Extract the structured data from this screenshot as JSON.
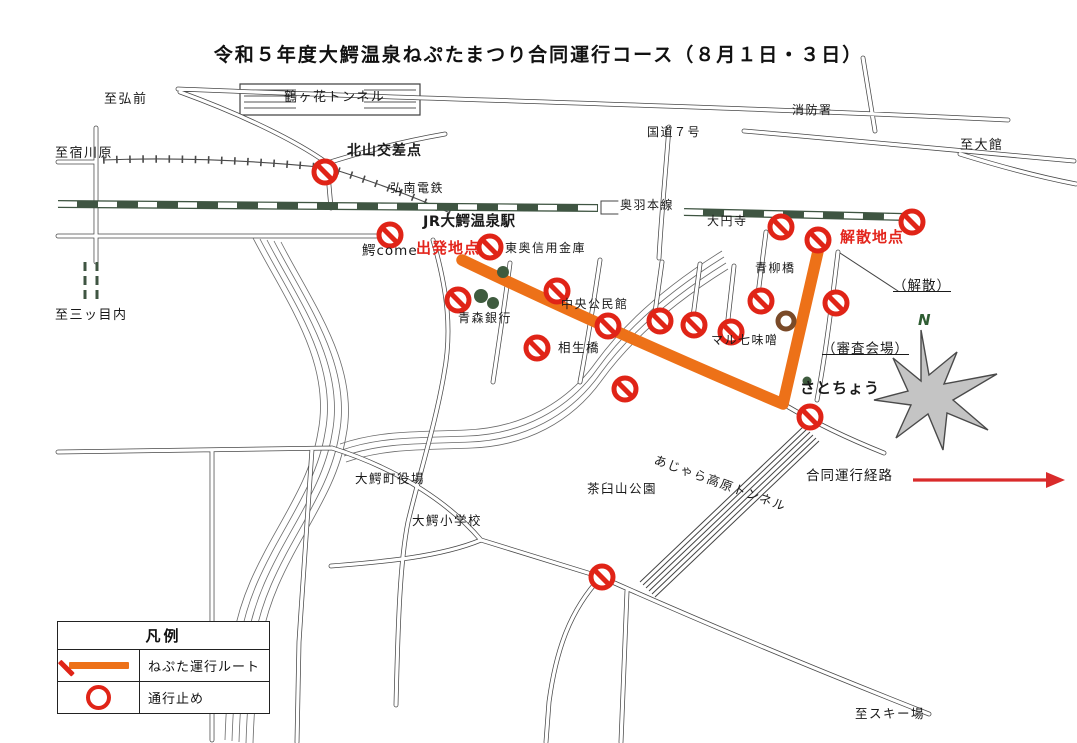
{
  "title": "令和５年度大鰐温泉ねぷたまつり合同運行コース（８月１日・３日）",
  "legend": {
    "title": "凡例",
    "rows": [
      {
        "symbol": "route-line",
        "label": "ねぷた運行ルート"
      },
      {
        "symbol": "no-entry-sign",
        "label": "通行止め"
      }
    ]
  },
  "map": {
    "start_label": "出発地点",
    "end_label": "解散地点",
    "route_direction_label": "合同運行経路",
    "compass_north_label": "N",
    "colors": {
      "route_orange": "#ED7118",
      "closure_red": "#E02417",
      "red_text": "#E3251C",
      "railway_green": "#3F5542",
      "tree_green": "#3E5B3E",
      "landmark_brown": "#7A4A28",
      "arrow_red": "#D92B2B"
    },
    "labels": [
      {
        "id": "to-hirosaki",
        "text": "至弘前",
        "x": 104,
        "y": 93,
        "cls": "s13"
      },
      {
        "id": "tsurugahana-tunnel",
        "text": "鶴ヶ花トンネル",
        "x": 284,
        "y": 91,
        "cls": "s13"
      },
      {
        "id": "to-shukugawara",
        "text": "至宿川原",
        "x": 55,
        "y": 147,
        "cls": "s13"
      },
      {
        "id": "kitayama-intersection",
        "text": "北山交差点",
        "x": 347,
        "y": 144,
        "cls": "b14"
      },
      {
        "id": "konan-railway",
        "text": "弘南電鉄",
        "x": 390,
        "y": 182,
        "cls": ""
      },
      {
        "id": "fire-station",
        "text": "消防署",
        "x": 792,
        "y": 104,
        "cls": ""
      },
      {
        "id": "route-7",
        "text": "国道７号",
        "x": 647,
        "y": 126,
        "cls": ""
      },
      {
        "id": "to-odate",
        "text": "至大館",
        "x": 960,
        "y": 139,
        "cls": "s13"
      },
      {
        "id": "ou-main-line",
        "text": "奥羽本線",
        "x": 620,
        "y": 199,
        "cls": ""
      },
      {
        "id": "daienji",
        "text": "大円寺",
        "x": 707,
        "y": 215,
        "cls": ""
      },
      {
        "id": "dispersal-point",
        "text": "解散地点",
        "x": 840,
        "y": 229,
        "cls": "red"
      },
      {
        "id": "jr-owani-onsen-station",
        "text": "JR大鰐温泉駅",
        "x": 423,
        "y": 215,
        "cls": "b145"
      },
      {
        "id": "departure-point",
        "text": "出発地点",
        "x": 416,
        "y": 240,
        "cls": "red"
      },
      {
        "id": "wani-come",
        "text": "鰐come",
        "x": 362,
        "y": 244,
        "cls": "s135"
      },
      {
        "id": "toou-shinkin-bank",
        "text": "東奥信用金庫",
        "x": 505,
        "y": 242,
        "cls": ""
      },
      {
        "id": "aomori-bank",
        "text": "青森銀行",
        "x": 458,
        "y": 312,
        "cls": ""
      },
      {
        "id": "central-community-hall",
        "text": "中央公民館",
        "x": 561,
        "y": 298,
        "cls": ""
      },
      {
        "id": "aioi-bridge",
        "text": "相生橋",
        "x": 558,
        "y": 341,
        "cls": "s125"
      },
      {
        "id": "aoyagi-bridge",
        "text": "青柳橋",
        "x": 755,
        "y": 262,
        "cls": ""
      },
      {
        "id": "dispersal-note",
        "text": "（解散）",
        "x": 893,
        "y": 279,
        "cls": "u"
      },
      {
        "id": "maru-shichi-miso",
        "text": "マル七味噌",
        "x": 711,
        "y": 334,
        "cls": ""
      },
      {
        "id": "judging-venue",
        "text": "（審査会場）",
        "x": 822,
        "y": 342,
        "cls": "u"
      },
      {
        "id": "satocho",
        "text": "さとちょう",
        "x": 800,
        "y": 380,
        "cls": "b15"
      },
      {
        "id": "to-mitsumenai",
        "text": "至三ッ目内",
        "x": 55,
        "y": 309,
        "cls": "s13"
      },
      {
        "id": "owani-town-hall",
        "text": "大鰐町役場",
        "x": 355,
        "y": 472,
        "cls": "s125"
      },
      {
        "id": "owani-elementary-school",
        "text": "大鰐小学校",
        "x": 412,
        "y": 514,
        "cls": "s125"
      },
      {
        "id": "chausuyama-park",
        "text": "茶臼山公園",
        "x": 587,
        "y": 482,
        "cls": "s125"
      },
      {
        "id": "ajara-kogen-tunnel",
        "text": "あじゃら高原トンネル",
        "x": 657,
        "y": 453,
        "cls": "s125",
        "rot": 20
      },
      {
        "id": "joint-route-direction",
        "text": "合同運行経路",
        "x": 806,
        "y": 469,
        "cls": "s135"
      },
      {
        "id": "to-ski-area",
        "text": "至スキー場",
        "x": 855,
        "y": 707,
        "cls": "s125"
      },
      {
        "id": "compass-n",
        "text": "N",
        "x": 918,
        "y": 312,
        "cls": "n"
      }
    ],
    "no_entry_signs": [
      [
        325,
        172
      ],
      [
        390,
        235
      ],
      [
        490,
        247
      ],
      [
        458,
        300
      ],
      [
        557,
        291
      ],
      [
        608,
        326
      ],
      [
        537,
        348
      ],
      [
        625,
        389
      ],
      [
        660,
        321
      ],
      [
        694,
        325
      ],
      [
        731,
        332
      ],
      [
        761,
        301
      ],
      [
        781,
        227
      ],
      [
        818,
        240
      ],
      [
        912,
        222
      ],
      [
        836,
        303
      ],
      [
        810,
        417
      ],
      [
        602,
        577
      ]
    ]
  }
}
